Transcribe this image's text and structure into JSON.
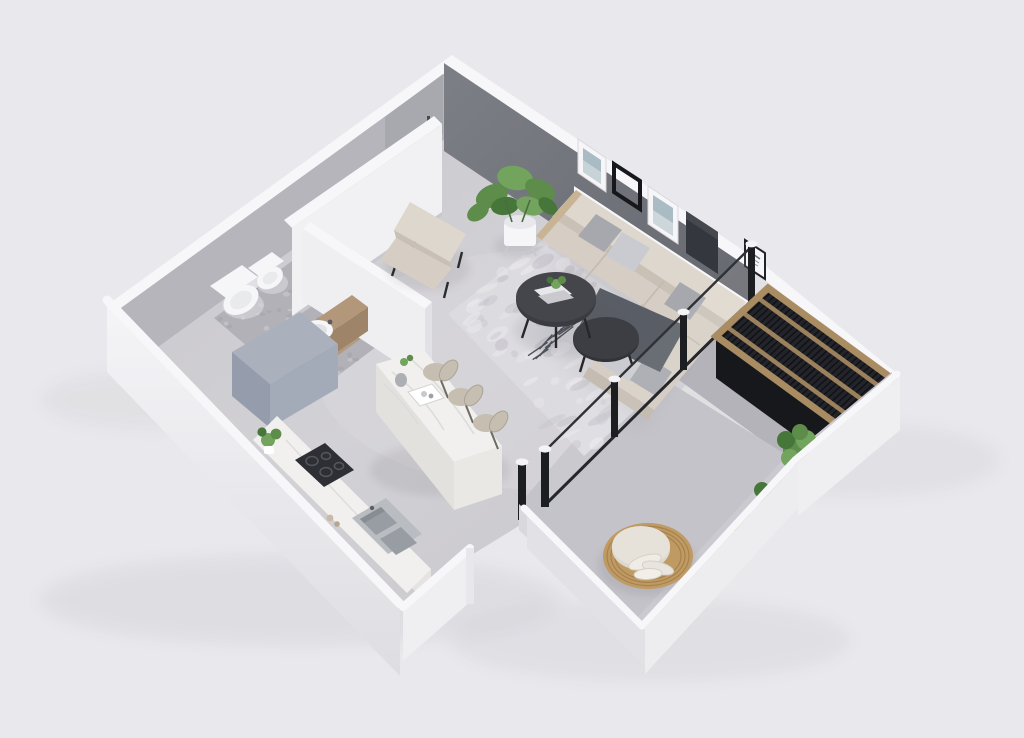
{
  "scene": {
    "type": "3d-isometric-floor-plan-render",
    "description": "Top-down 3D render of a small apartment with entrance hall, bathroom, open kitchen and living room, covered balcony with slatted pergola, and terrace with round rattan chair",
    "background_color": "#e9e8ec",
    "palette": {
      "bg": "#e9e8ec",
      "wallTop": "#f7f7fa",
      "wallLight": "#f1f1f4",
      "wallMid": "#e2e1e6",
      "wallShade": "#b6b5bc",
      "wallOuterLit": "#efeff2",
      "accentWall": "#6f7178",
      "accentWallLight": "#84868d",
      "floorMain": "#cbcacf",
      "floorLight": "#d8d7db",
      "floorOutdoor": "#c4c3c9",
      "floorBalcony": "#b4b3ba",
      "floorBath": "#b2b1b8",
      "pebbleLight": "#c9c8ce",
      "pebbleDark": "#a5a5ac",
      "rug": "#dcdbdf",
      "rugDark": "#c5c4ca",
      "rugLight": "#ebeaee",
      "sofa": "#d6cec4",
      "sofaShade": "#c4bcb1",
      "sofaLight": "#ded7cd",
      "pillowGray": "#a6a8ae",
      "pillowLight": "#c9cbd0",
      "throw": "#595d65",
      "tableDark": "#3b3c41",
      "tableDark2": "#323338",
      "wood": "#b2977a",
      "woodDark": "#9e8569",
      "marble": "#f1f0ef",
      "marbleSide": "#e3e1de",
      "marbleSide2": "#eae8e5",
      "stool": "#c6bfb1",
      "stoolDark": "#a49d8f",
      "cooktop": "#2e2f34",
      "steel": "#b9bdc1",
      "steelDark": "#979da3",
      "green": "#5d8c4b",
      "greenLight": "#72a45e",
      "greenDark": "#47763a",
      "white": "#f6f6f8",
      "showerTop": "#aab1bd",
      "showerSide": "#959dac",
      "showerFront": "#a3abb8",
      "pergolaWood": "#a98c62",
      "pergolaDark": "#232429",
      "pergolaFace": "#17181c",
      "pergolaLine": "#101116",
      "rattan": "#bf9a63",
      "rattanDark": "#9f7c49",
      "cushion": "#ddd8cf",
      "frameDark": "#34373d",
      "black": "#1d1e22",
      "doorGray": "#a7a9ae",
      "artBlue": "#a9bcc4",
      "shadow": "#55555e"
    },
    "rooms": [
      {
        "name": "entrance-hall",
        "features": [
          "front-door",
          "tall-white-wardrobe-wall"
        ]
      },
      {
        "name": "bathroom",
        "features": [
          "toilet",
          "bidet",
          "wood-vanity-with-vessel-sink",
          "gray-shower-cube",
          "pebble-floor"
        ]
      },
      {
        "name": "kitchen",
        "features": [
          "marble-island",
          "three-bar-stools",
          "wall-counter-with-cooktop",
          "double-steel-sink",
          "counter-plant",
          "plates"
        ]
      },
      {
        "name": "living-room",
        "features": [
          "l-shaped-beige-sofa",
          "gray-pillows",
          "dark-throw-blanket",
          "two-round-black-coffee-tables",
          "distressed-gray-rug",
          "beige-armchair",
          "monstera-plant-in-white-pot",
          "dark-accent-wall",
          "white-picture-ledge",
          "five-art-frames",
          "glass-sliding-doors"
        ]
      },
      {
        "name": "balcony",
        "features": [
          "wood-slat-pergola",
          "dark-louvered-roof"
        ]
      },
      {
        "name": "terrace",
        "features": [
          "round-rattan-papasan-chair",
          "white-cushions",
          "green-shrubs",
          "low-parapet-walls",
          "black-door-frames"
        ]
      }
    ]
  }
}
